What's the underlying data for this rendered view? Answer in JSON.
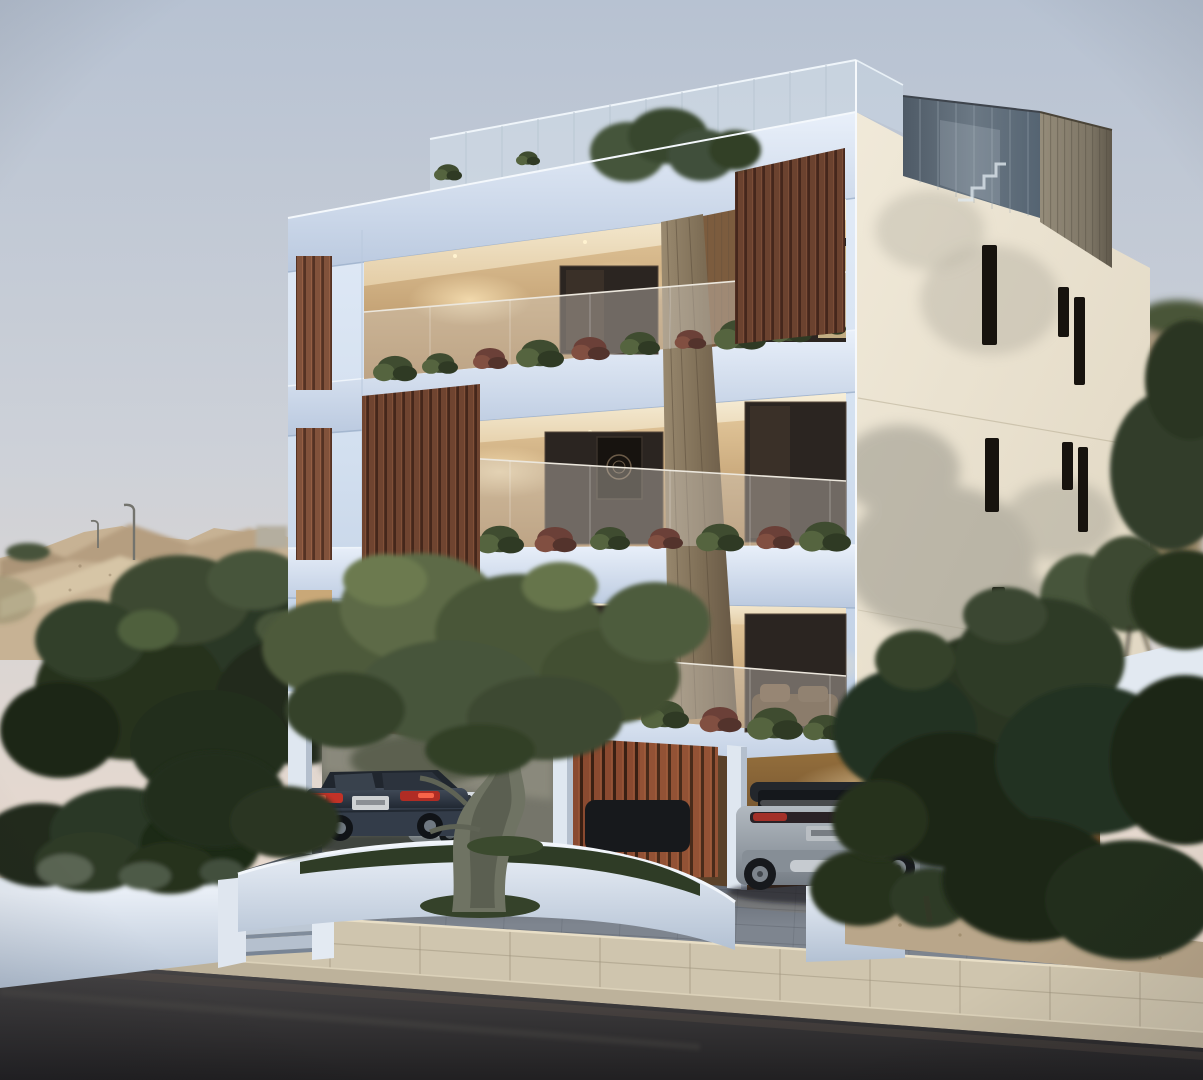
{
  "canvas": {
    "width": 1203,
    "height": 1080
  },
  "palette": {
    "sky_top": "#b7c2d2",
    "sky_mid": "#d3d4d8",
    "sky_horizon": "#ecdaca",
    "hill": "#c7b294",
    "hill_shadow": "#a6907634",
    "foliage_dark": "#26301f",
    "foliage_mid": "#3c4a31",
    "foliage_light": "#5c6a45",
    "olive_foliage": "#556240",
    "olive_trunk": "#6f7363",
    "facade_front": "#d7e3f2",
    "facade_front_shadow": "#b5c7de",
    "facade_side": "#ece4d2",
    "facade_side_shadow": "#cfc5b0",
    "slat_wood": "#7a4b36",
    "slat_wood_dark": "#4e2d20",
    "column_wood": "#8a7a62",
    "interior_warm": "#dfc094",
    "interior_glow": "#f6e3b8",
    "glass_dark": "#28231e",
    "balcony_glass": "#cfc8be",
    "roof_glass": "#57646f",
    "roof_wood": "#8b8271",
    "window_slit": "#17130e",
    "planter_white": "#e8eef6",
    "planter_shadow": "#b9c6d7",
    "driveway": "#7e858f",
    "sidewalk": "#cfc5ae",
    "curb": "#bdb29b",
    "road": "#403f41",
    "road_dark": "#232224",
    "sand": "#b9a68a",
    "car_sedan": "#333c49",
    "car_sedan_taillight": "#c23227",
    "car_white": "#d7dce1",
    "car_dark": "#17191c",
    "suv_body": "#9aa2aa",
    "suv_roof": "#23272c",
    "suv_taillight": "#a33028",
    "lamp_pole": "#73736d"
  },
  "scene": {
    "type": "exterior-architectural-render",
    "time_of_day": "dusk",
    "building": {
      "floors_visible": 3,
      "ground_level": "open-parking-pilotis",
      "roof_features": [
        "glass-railing-terrace",
        "wood-clad-stair-box",
        "roof-tree"
      ],
      "front_facade_features": [
        "recessed-balconies",
        "warm-lit-interiors",
        "glass-balustrades",
        "balcony-planters",
        "vertical-wood-slat-screens",
        "central-wood-column"
      ],
      "side_facade_features": [
        "cream-render",
        "narrow-vertical-slit-windows",
        "tree-shadow"
      ]
    },
    "vehicles": [
      {
        "name": "dark-sedan"
      },
      {
        "name": "white-car"
      },
      {
        "name": "dark-parked-car"
      },
      {
        "name": "grey-suv"
      }
    ],
    "landscape": [
      "dirt-hillside",
      "street-lamps",
      "left-tree-group",
      "olive-tree",
      "white-planter-walls",
      "entry-steps",
      "shrubs",
      "right-tree-group",
      "terrace-planter-trees",
      "sandy-verge",
      "paved-driveway",
      "concrete-sidewalk",
      "asphalt-road"
    ]
  }
}
